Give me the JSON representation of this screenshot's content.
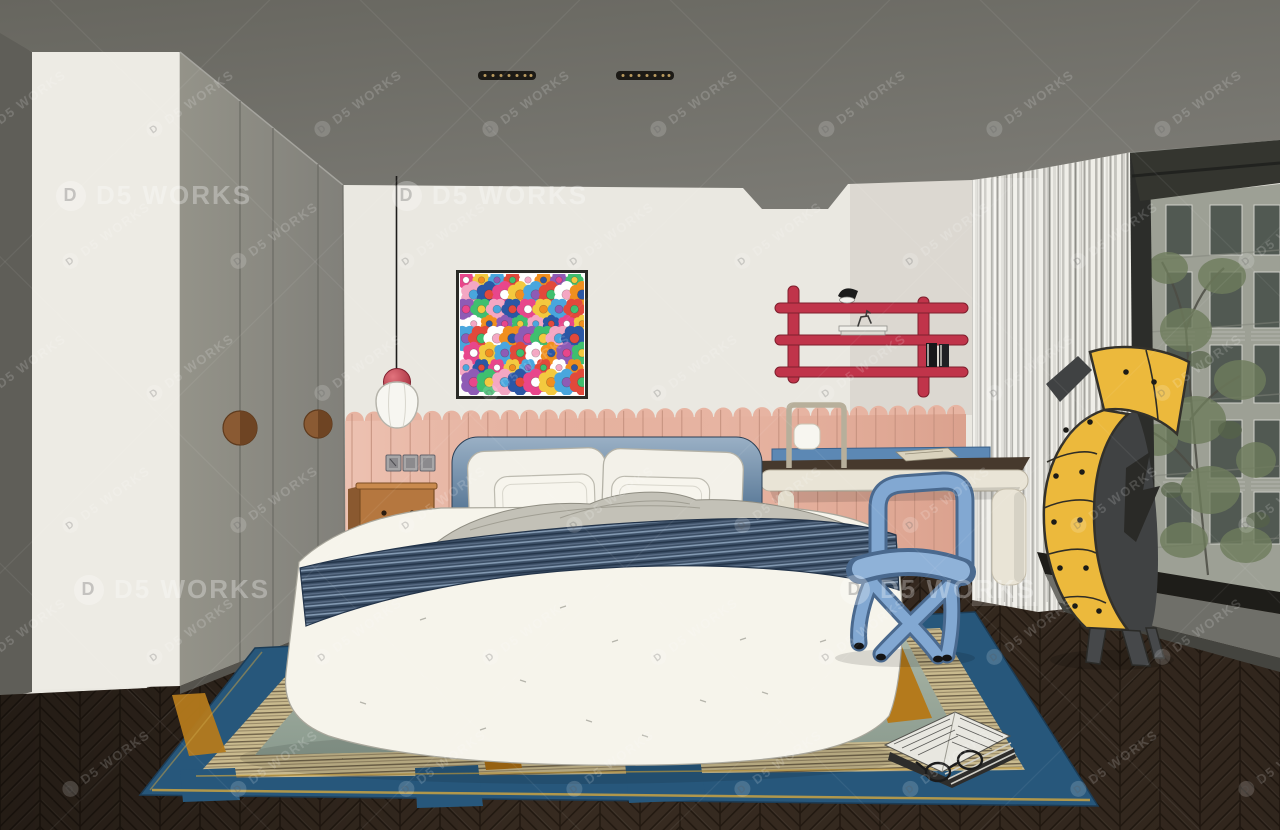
{
  "watermark": {
    "text": "D5 WORKS",
    "logo_letter": "D"
  },
  "palette": {
    "ceiling": "#73726c",
    "side_wall": "#5f5e58",
    "wardrobe_panel": "#edebe4",
    "closet_door": "#8b8a84",
    "wall": "#eae8e1",
    "wainscot": "#e7b4a2",
    "wainscot_line": "#c4907d",
    "headboard_top": "#9ab0c5",
    "headboard_bottom": "#31506d",
    "duvet": "#f6f4eb",
    "blanket_gray": "#c3c1b7",
    "navy_blanket": "#3c4f66",
    "pillow": "#f3f1e9",
    "nightstand_wood": "#b5773f",
    "shelf_red": "#c0344a",
    "desk_base": "#e9e4d6",
    "desk_top": "#46392d",
    "chair_blue": "#82a8d2",
    "chair_blue_dark": "#4a698e",
    "cabinet_yellow": "#ecb93c",
    "curtain_light": "#efeee8",
    "window_frame": "#34352f",
    "facade": "#9da095",
    "tree_green": "#6e7c5c",
    "floor_wood": "#3b2e23",
    "ledge_gray": "#6f6f69",
    "rug_blue": "#27577b",
    "rug_center": "#9fae9e",
    "rug_beige": "#c9ba8e",
    "rug_amber": "#b47a1c",
    "rug_gold": "#c9a243",
    "lamp_red": "#c0394a"
  },
  "artwork": {
    "name": "flower-field-painting",
    "colors": [
      "#e8468b",
      "#f3c93f",
      "#49a6dd",
      "#e2493b",
      "#ffffff",
      "#f08f1f",
      "#8e5bb5",
      "#3fbf6f",
      "#f4a7c3",
      "#2b57a5"
    ]
  },
  "objects": [
    "gray-ceiling-with-linear-vents",
    "white-wardrobe-panel",
    "gray-closet-doors-round-wood-handles",
    "flower-artwork",
    "pendant-lamp-red-ball-white-shade",
    "pink-slatted-wainscot",
    "light-switches",
    "red-wall-shelf-with-lamp-books",
    "wood-nightstand",
    "bed-blue-headboard-white-duvet-navy-throw",
    "white-desk-dark-top-blue-rail",
    "frame-desk-lamp",
    "blue-bold-tube-chair",
    "yellow-banana-drawer-cabinet",
    "sheer-curtain",
    "window-city-view-tree",
    "herringbone-wood-floor",
    "blue-green-striped-rug",
    "open-book-with-glasses"
  ]
}
